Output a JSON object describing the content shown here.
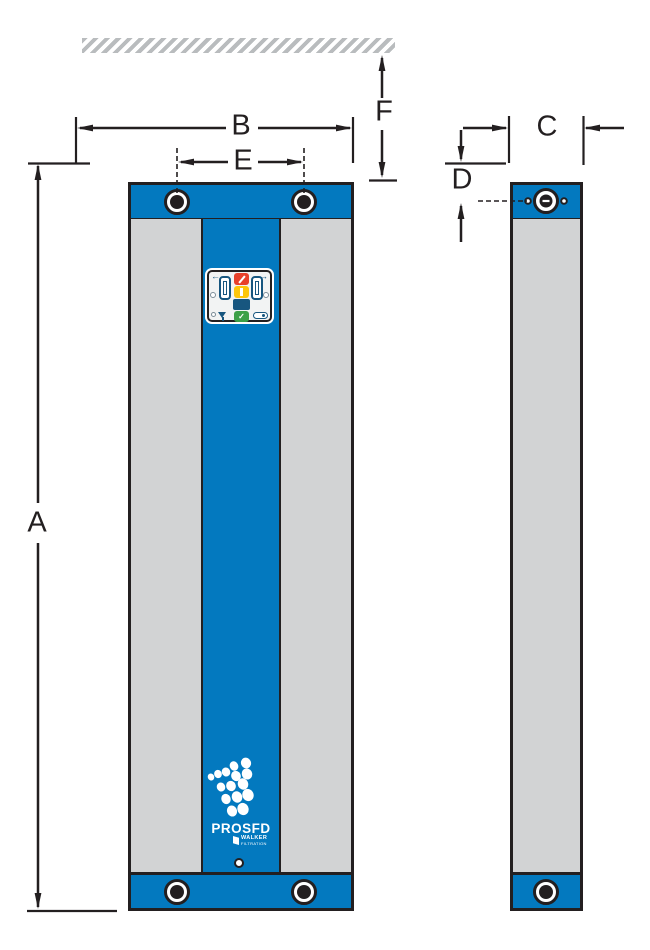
{
  "diagram": {
    "dimension_labels": {
      "a": "A",
      "b": "B",
      "c": "C",
      "d": "D",
      "e": "E",
      "f": "F"
    },
    "product": {
      "name": "PROSFD",
      "brand_line1": "WALKER",
      "brand_line2": "FILTRATION"
    },
    "panel": {
      "arrow_left": "←",
      "arrow_right": "→",
      "check": "✓",
      "icon_names": [
        "left-arrow-icon",
        "tower-gauge-left-icon",
        "stop-button",
        "standby-button",
        "display-screen",
        "run-button",
        "tower-gauge-right-icon",
        "right-arrow-icon",
        "drain-funnel-icon",
        "drain-valve-icon"
      ]
    },
    "colors": {
      "blue": "#0379bf",
      "grey": "#d2d3d4",
      "line": "#231f20",
      "hatch": "#b9bcbe",
      "red": "#e8402a",
      "yellow": "#fdc60b",
      "navy": "#17567f",
      "green": "#3da047",
      "panel": "#f2f3f3"
    }
  }
}
